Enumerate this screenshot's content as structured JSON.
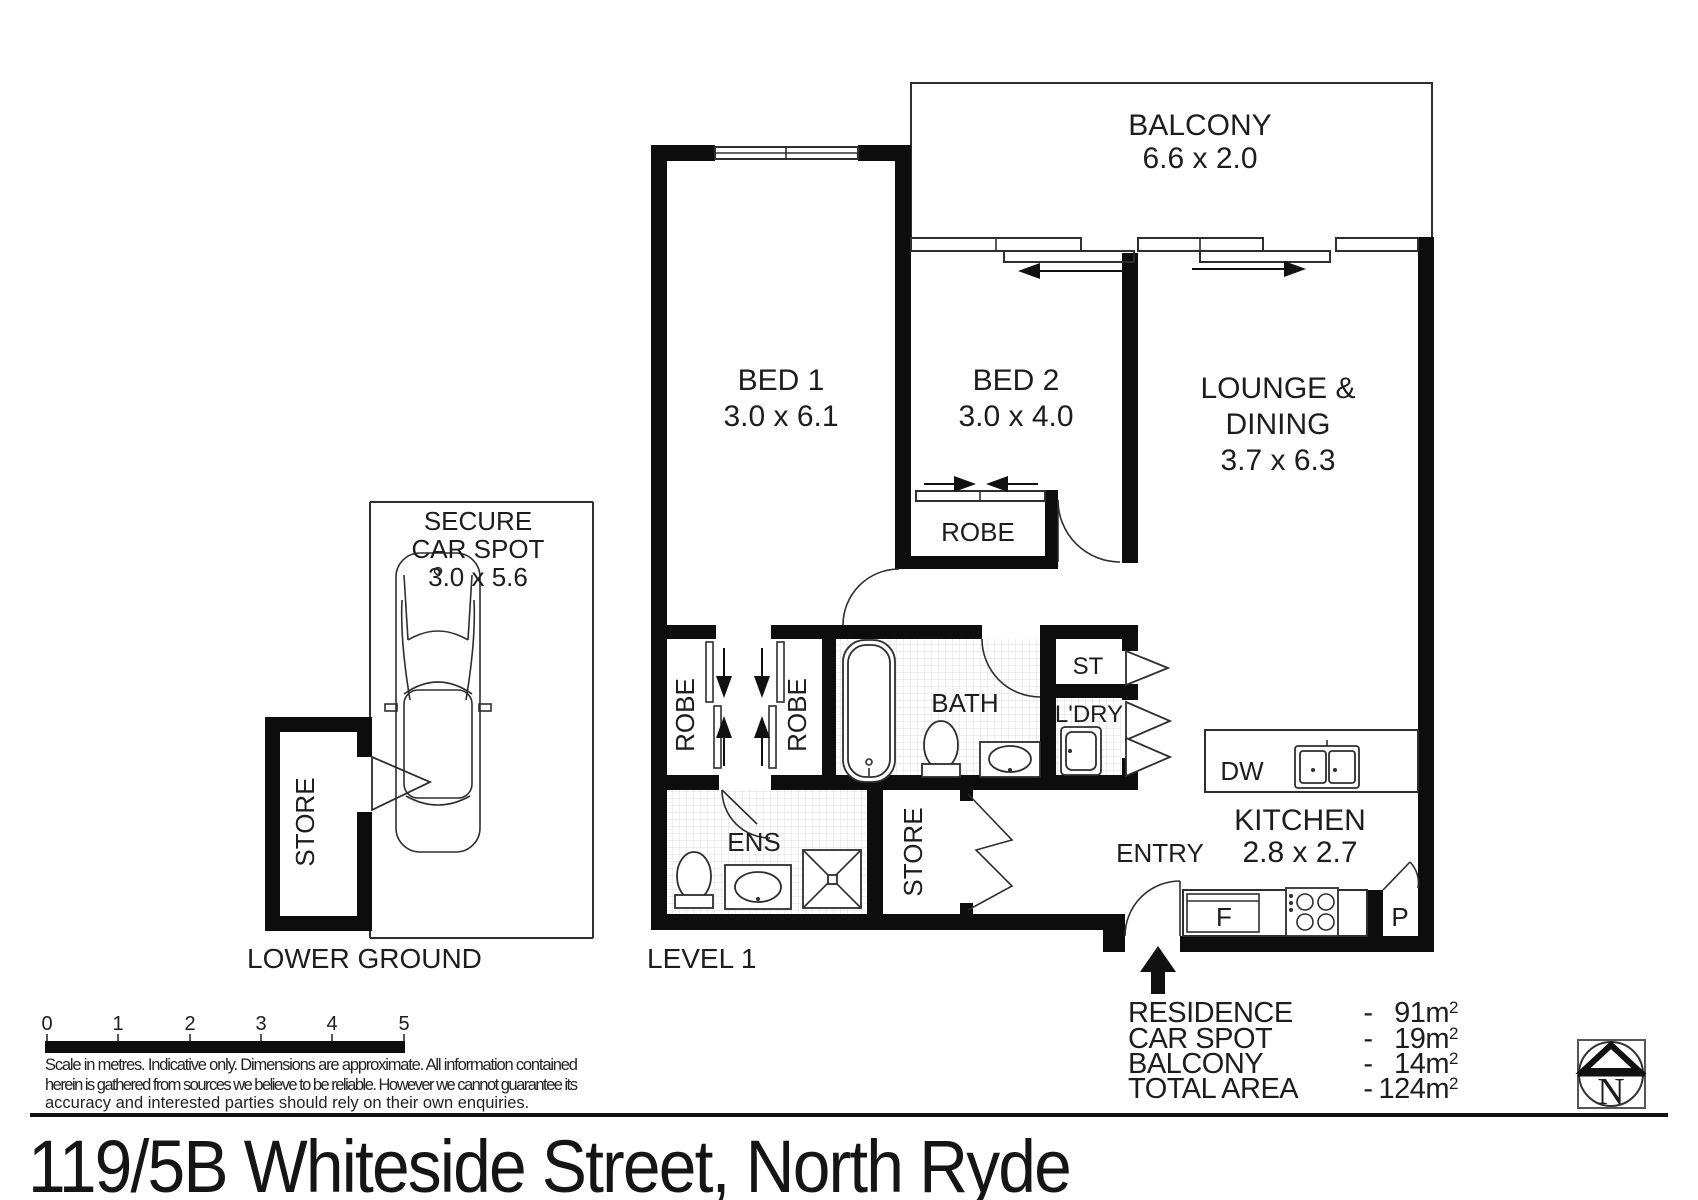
{
  "title": "119/5B Whiteside Street, North Ryde",
  "plan": {
    "level1_label": "LEVEL 1",
    "lower_ground_label": "LOWER GROUND",
    "rooms": {
      "balcony": {
        "name": "BALCONY",
        "dims": "6.6 x 2.0"
      },
      "bed1": {
        "name": "BED 1",
        "dims": "3.0 x 6.1"
      },
      "bed2": {
        "name": "BED 2",
        "dims": "3.0 x 4.0"
      },
      "lounge": {
        "name_line1": "LOUNGE &",
        "name_line2": "DINING",
        "dims": "3.7 x 6.3"
      },
      "kitchen": {
        "name": "KITCHEN",
        "dims": "2.8 x 2.7"
      },
      "car_spot": {
        "name_line1": "SECURE",
        "name_line2": "CAR SPOT",
        "dims": "3.0 x 5.6"
      }
    },
    "labels": {
      "robe": "ROBE",
      "bath": "BATH",
      "st": "ST",
      "ldry": "L'DRY",
      "ens": "ENS",
      "store": "STORE",
      "entry": "ENTRY",
      "dw": "DW",
      "fridge": "F",
      "pantry": "P"
    }
  },
  "areas": {
    "rows": [
      {
        "label": "RESIDENCE",
        "sep": "-",
        "value": "91m",
        "sup": "2"
      },
      {
        "label": "CAR SPOT",
        "sep": "-",
        "value": "19m",
        "sup": "2"
      },
      {
        "label": "BALCONY",
        "sep": "-",
        "value": "14m",
        "sup": "2"
      },
      {
        "label": "TOTAL AREA",
        "sep": "-",
        "value": "124m",
        "sup": "2"
      }
    ]
  },
  "scale_bar": {
    "ticks": [
      "0",
      "1",
      "2",
      "3",
      "4",
      "5"
    ]
  },
  "disclaimer": {
    "line1": "Scale in metres. Indicative only. Dimensions are approximate. All information contained",
    "line2": "herein is gathered from sources we believe to be reliable. However we cannot guarantee its",
    "line3": "accuracy and interested parties should rely on their own enquiries."
  },
  "compass": {
    "label": "N"
  }
}
